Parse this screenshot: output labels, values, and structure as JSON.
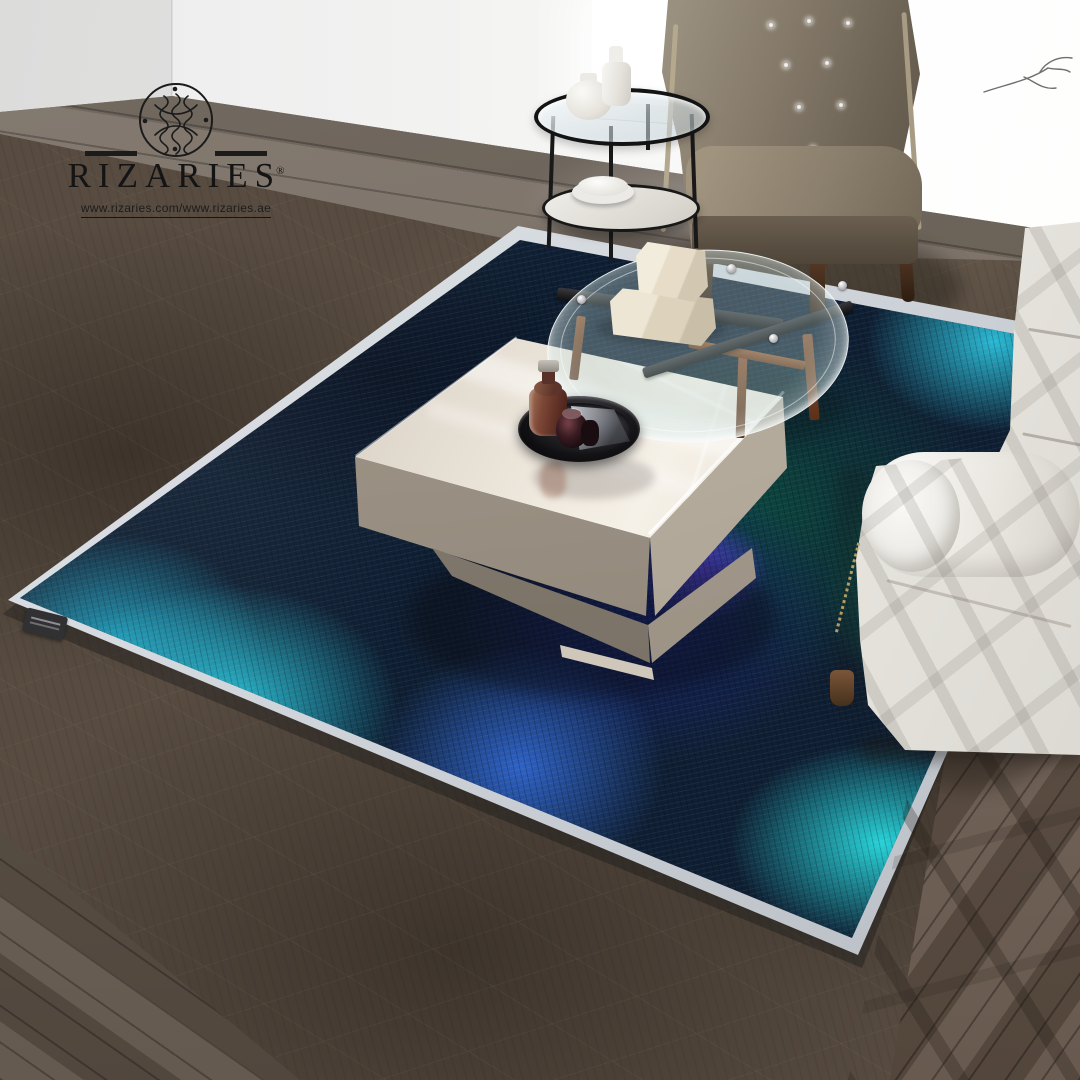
{
  "logo": {
    "brand": "RIZARIES",
    "registered": "®",
    "url": "www.rizaries.com/www.rizaries.ae",
    "monogram_icon": "interlaced-calligraphic-loops",
    "branch_icon": "thin-branch-sketch"
  },
  "palette": {
    "wallLeft": "#dcdcdb",
    "wallBack": "#f2f2f1",
    "floorWood": "#756b60",
    "floorWoodWarm": "#6d5c4c",
    "carpet": "#584c41",
    "rugBinding": "#ccd1d7",
    "rugBase": "#0f1f33",
    "rugTurquoise": "#25c0d6",
    "rugRoyal": "#2e62c6",
    "rugIce": "#cfeef5",
    "rugNavy": "#16246b",
    "rugTealDark": "#0c463e",
    "rugGreen": "#12a96e",
    "rugEmerald": "#19c585",
    "rugCyan": "#27d2d8",
    "rugPurple": "#4f43cf",
    "sofa": "#f4f2ee",
    "chair": "#857a6a",
    "chairDark": "#4f4538",
    "tableCream": "#f6f1e8",
    "tableFace": "#958b7e",
    "trayBlack": "#0a0a0c",
    "bottleAmber": "#7d4736",
    "woodLeg": "#5c3119",
    "logoInk": "#1b1b1b"
  }
}
